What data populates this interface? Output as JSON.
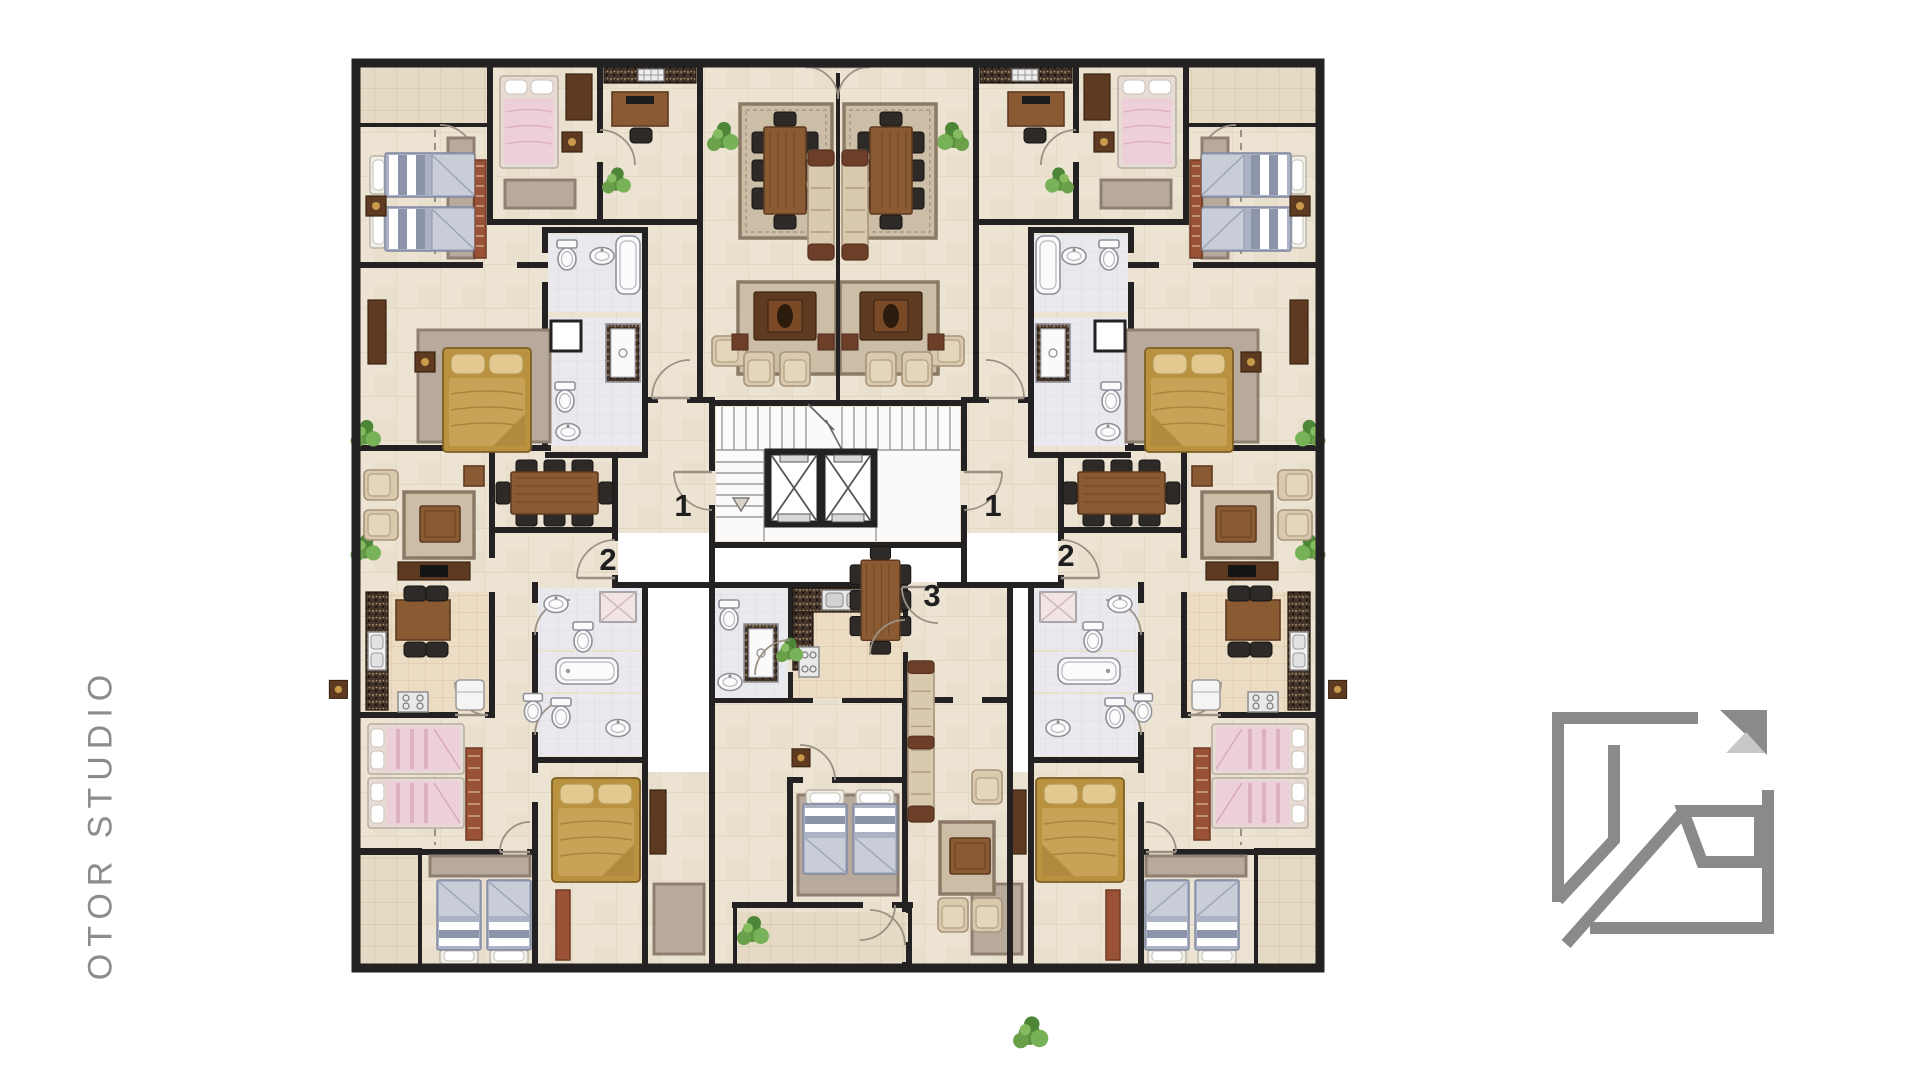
{
  "branding": {
    "studio_name": "OTOR STUDIO",
    "logo": {
      "name": "otor-studio-logo",
      "primary_color": "#8a8a8a",
      "accent_color": "#c8c8c8"
    }
  },
  "floorplan": {
    "type": "residential-apartment-floor-plan",
    "units_visible": [
      "1",
      "1",
      "2",
      "2",
      "3"
    ],
    "unit_labels": [
      {
        "name": "unit-entrance-label-1-left",
        "label": "1"
      },
      {
        "name": "unit-entrance-label-1-right",
        "label": "1"
      },
      {
        "name": "unit-entrance-label-2-left",
        "label": "2"
      },
      {
        "name": "unit-entrance-label-2-right",
        "label": "2"
      },
      {
        "name": "unit-entrance-label-3-center",
        "label": "3"
      }
    ],
    "core": {
      "elevator_count": 2,
      "stair_flights": 2
    },
    "palette": {
      "background": "#ffffff",
      "floor": "#ece3d3",
      "terrace_tile": "#e5dac3",
      "kitchen_tile": "#ecdcc3",
      "bathroom_floor": "#eaeaee",
      "wall": "#232122",
      "wood": "#8a5a33",
      "dark_wood": "#5e3a20",
      "sofa_beige": "#d9c9ae",
      "cushion_brown": "#6e3f28",
      "gold_bed": "#c8a256",
      "blue_bed": "#8b94a8",
      "pink_bed": "#eccfd8",
      "plant_green": "#5d9441",
      "rug": "#c3b6a2",
      "runner_red": "#9a5236",
      "label_color": "#1f1f1f",
      "studio_name_color": "#8c8c8c",
      "logo_primary": "#8a8a8a",
      "logo_accent": "#c8c8c8"
    }
  }
}
